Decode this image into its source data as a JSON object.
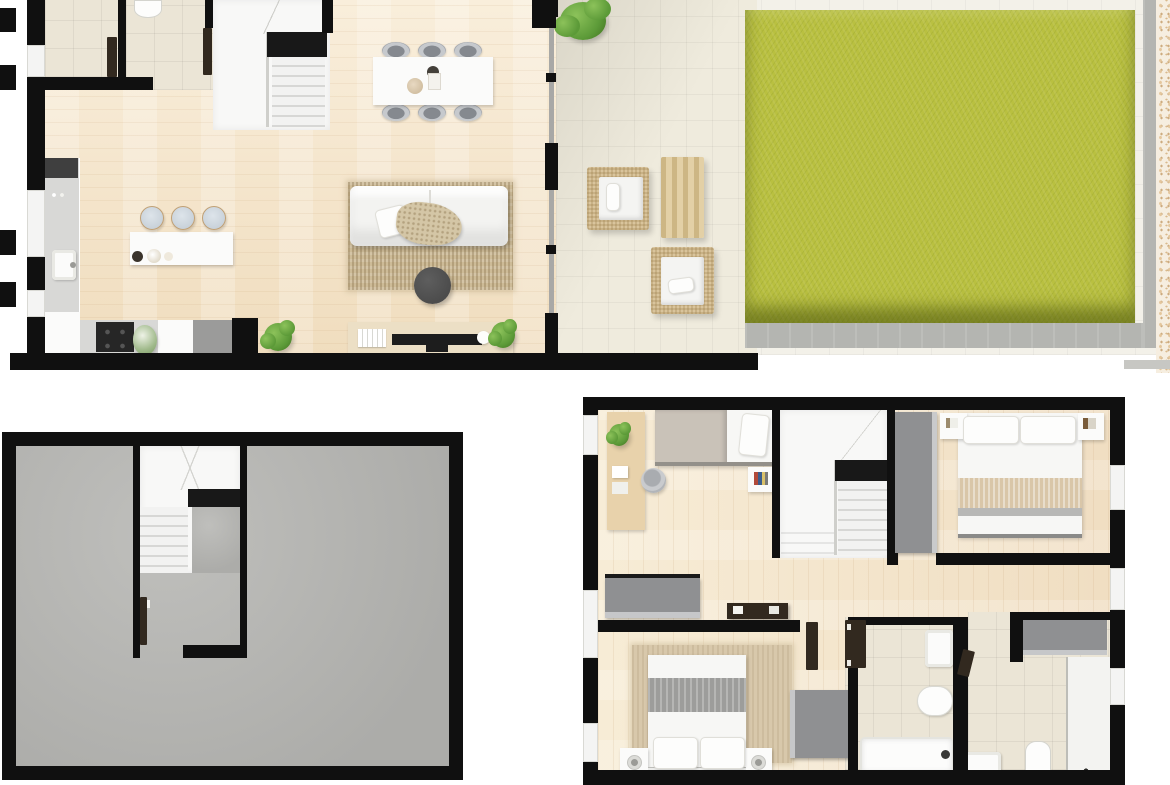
{
  "meta": {
    "type": "architectural-floor-plan-rendering",
    "view": "top-down 3d render",
    "plans_count": 3
  },
  "colors": {
    "wall": "#101010",
    "sill": "#f4f4f3",
    "dark_door": "#32291f",
    "tile": "#ebe5d6",
    "tile_terrace": "#efebdd",
    "pavement": "#f3f1e9",
    "grass": "#b9c040",
    "stone": "#b4b5b1",
    "terrazzo_base": "#f6eee0",
    "counter": "#d8d8d6",
    "stool": "#c9d2da",
    "sofa": "#f3f3f1",
    "rug": "#cdbb97",
    "coffee_table": "#4c4c4c",
    "tv": "#1d1d1d",
    "console_wood": "#ecdfc5",
    "rattan": "#d9c49c",
    "cushion": "#f4f4f2",
    "gray_wardrobe": "#8f9092",
    "stair_band": "#181818",
    "tread_light": "#f2f2f1",
    "tread_dark": "#d7d7d5",
    "bed_white": "#f7f7f5",
    "bed_gray_band": "#9d9d9b",
    "bed_tan_band": "#d9c6a8",
    "blanket": "#c9c2b8",
    "plant": "#5c9a38",
    "plant_light": "#8cc25a",
    "fixture_white": "#fbfbfa",
    "glass": "#a8a8a6"
  },
  "plans": [
    {
      "id": "ground-floor",
      "rooms": [
        "entry",
        "wc",
        "staircase",
        "kitchen",
        "dining-area",
        "living-room",
        "terrace",
        "garden"
      ],
      "furniture": [
        "toilet",
        "kitchen-counter",
        "kitchen-sink",
        "cooktop",
        "kitchen-island",
        "bar-stool x3",
        "dining-table",
        "dining-chair x6",
        "sofa",
        "area-rug",
        "coffee-table",
        "tv-sideboard",
        "tv",
        "potted-plant x3",
        "rattan-armchair x2",
        "rattan-side-table",
        "lawn",
        "shrub"
      ]
    },
    {
      "id": "basement",
      "rooms": [
        "open-basement",
        "staircase"
      ],
      "furniture": [
        "stair-door"
      ]
    },
    {
      "id": "first-floor",
      "rooms": [
        "bedroom-1",
        "bedroom-2",
        "master-bedroom",
        "hallway",
        "staircase",
        "bathroom-1",
        "bathroom-2"
      ],
      "furniture": [
        "single-bed",
        "desk",
        "desk-chair",
        "wardrobe x4",
        "double-bed x2",
        "nightstand x4",
        "bathtub",
        "freestanding-toilet",
        "toilet",
        "washbasin x2",
        "shower",
        "hall-console"
      ]
    }
  ]
}
